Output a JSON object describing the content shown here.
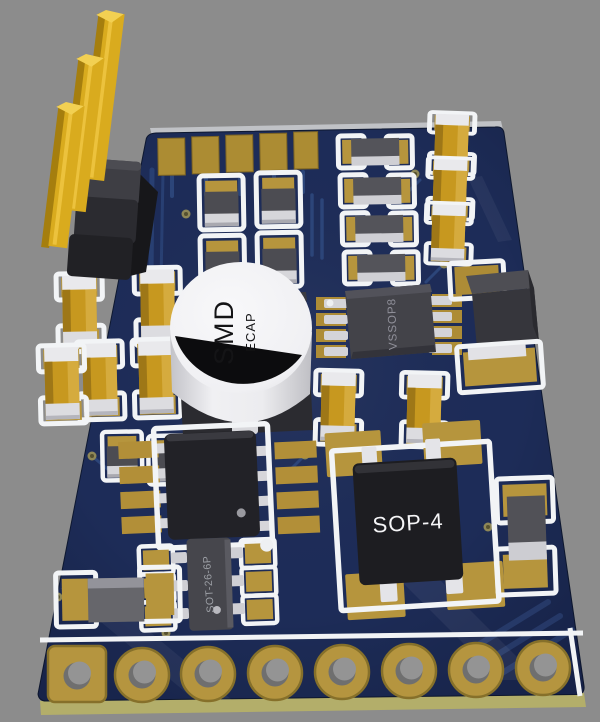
{
  "scene": {
    "type": "3d-pcb-render",
    "background_color": "#8c8c8c",
    "board": {
      "top_color": "#1d2c58",
      "side_color": "#b3ae6a",
      "silkscreen_color": "#f2f4f6",
      "pad_color": "#b6953d",
      "trace_color": "#2c4579"
    },
    "labels": {
      "ecap_primary": "SMD",
      "ecap_secondary": "ECAP",
      "ic_vssop": "VSSOP8",
      "ic_sop": "SOP-4",
      "ic_sot": "SOT-26-6P"
    },
    "components": {
      "pin_header_pins": 3,
      "edge_fingers": 5,
      "chip_capacitors": 10,
      "chip_resistors": 12,
      "through_hole_pads": 8,
      "ics": [
        "VSSOP8",
        "SOP-4",
        "SOT-26-6P",
        "SOIC-8 (unlabeled)",
        "SMD ECAP",
        "power box (unlabeled)"
      ]
    },
    "colors": {
      "capacitor_body": "#c7981f",
      "capacitor_ends": "#e9e9ec",
      "resistor_body": "#4c4c52",
      "resistor_end": "#d6d6da",
      "ic_body": "#222227",
      "ecap_body": "#f3f3f5",
      "pin_gold": "#d9ab1e",
      "header_plastic": "#2b2b30"
    }
  }
}
